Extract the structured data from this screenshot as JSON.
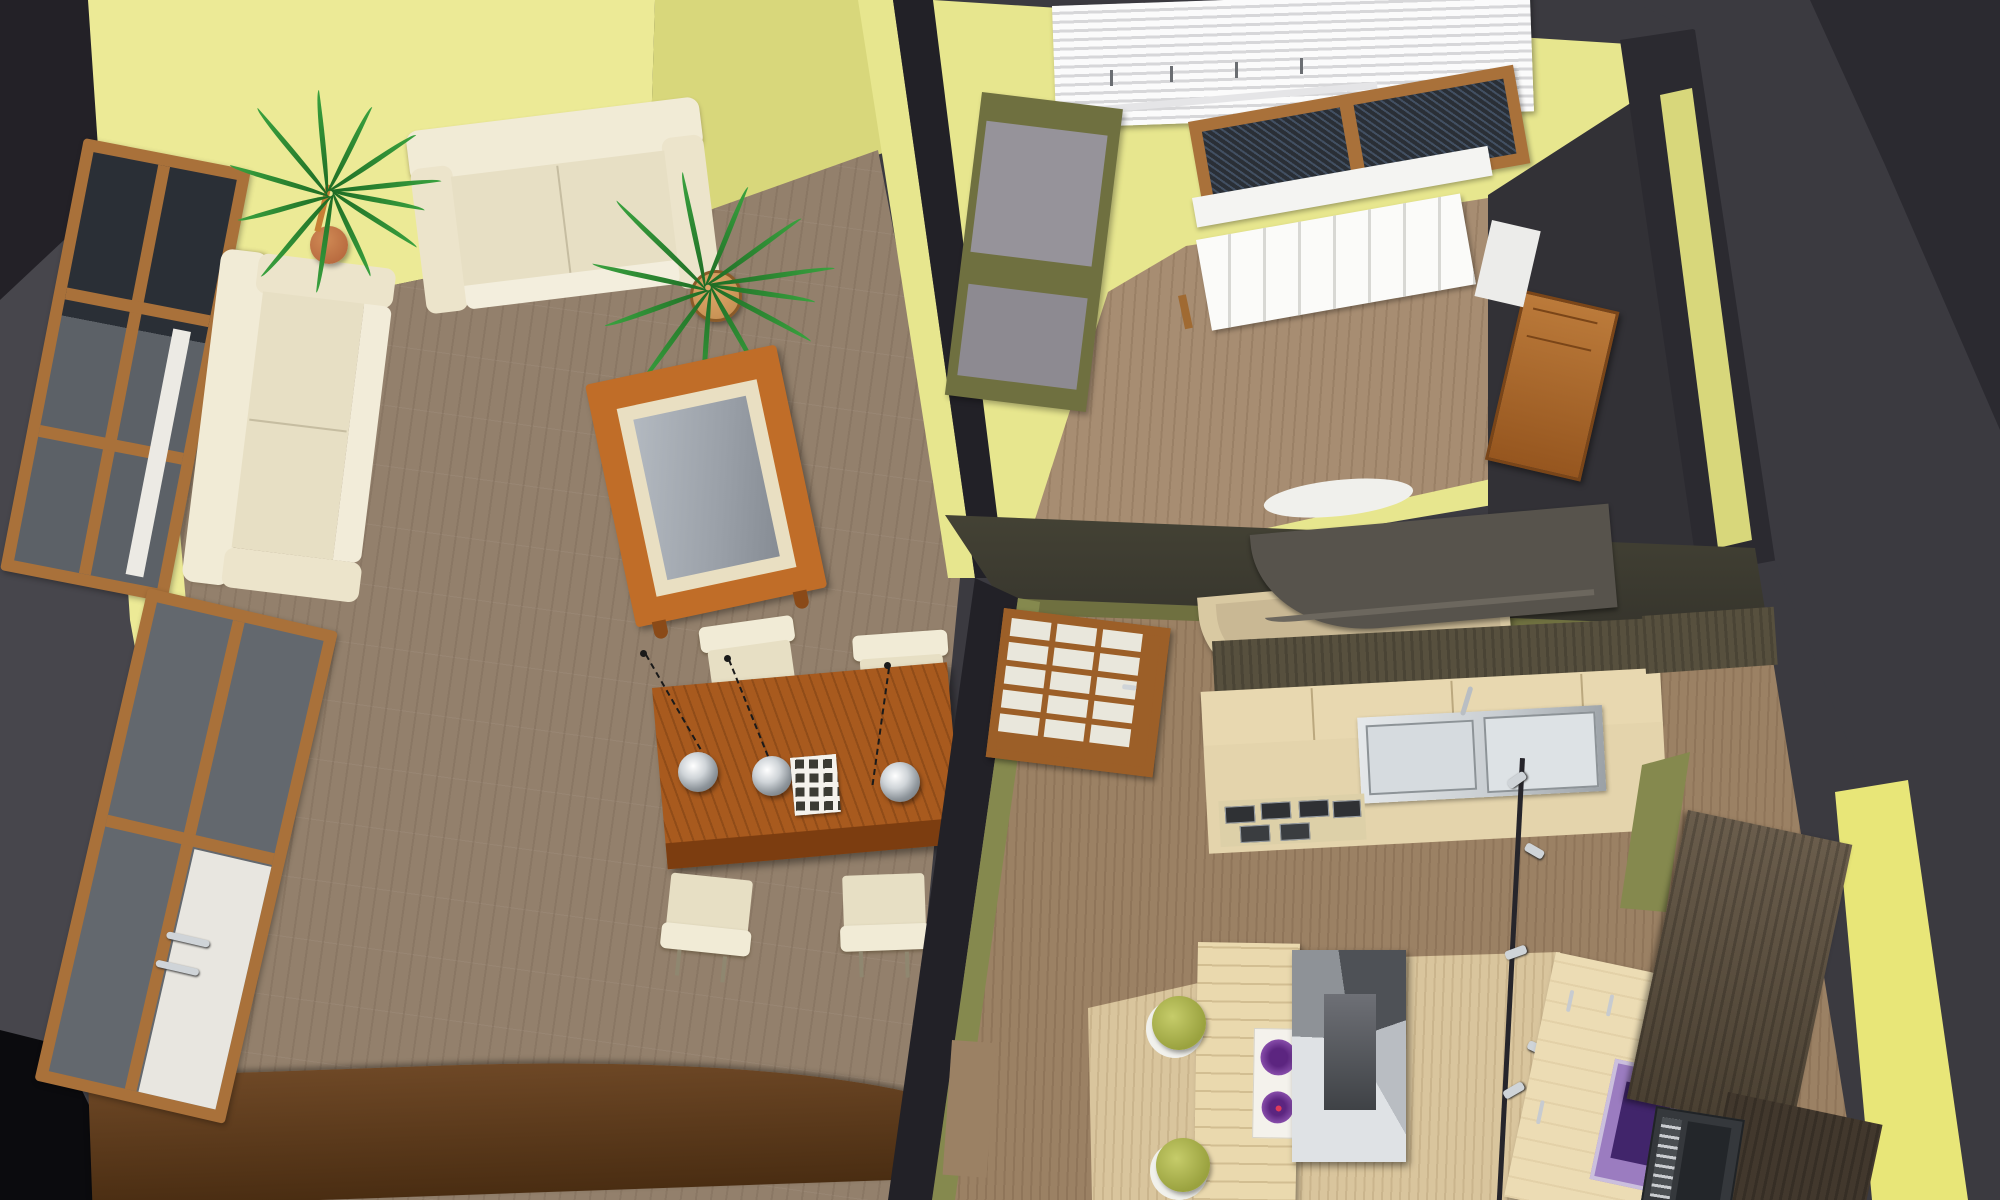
{
  "scene": {
    "type": "3d-interior-rendering",
    "view": "bird's-eye cutaway perspective of a small apartment (no on-screen text)",
    "rooms": [
      {
        "name": "living-room",
        "wall_color": "#ecea96",
        "floor_color": "#93806c",
        "objects": [
          "cream-corner-sofa-long",
          "cream-corner-sofa-short",
          "potted-palm-small",
          "potted-palm-large",
          "coffee-table-with-glass-top",
          "dining-table",
          "dining-chair-x4",
          "pendant-lamp-x3",
          "white-lattice-tray",
          "low-sideboard",
          "wood-frame-window",
          "balcony-door-window"
        ]
      },
      {
        "name": "bedroom",
        "wall_color": "#e7e68e",
        "floor_color": "#a78d72",
        "objects": [
          "venetian-blinds",
          "wood-frame-window-dark-glass",
          "white-windowsill",
          "white-radiator",
          "gray-shelving-unit"
        ]
      },
      {
        "name": "hallway",
        "wall_color": "#323136",
        "objects": [
          "wooden-door",
          "white-door-panel"
        ]
      },
      {
        "name": "kitchen",
        "wall_color": "#85894e",
        "floor_color": "#9b8164",
        "objects": [
          "glazed-interior-door",
          "curved-breakfast-bar",
          "upper-cabinet-run",
          "counter-with-double-sink",
          "faucet",
          "gas-hob",
          "kitchen-island",
          "two-burner-cooktop",
          "extractor-hood",
          "bar-stool-x2",
          "track-light-pole",
          "purple-microwave",
          "purple-oven",
          "walnut-tall-cabinet-x2",
          "dark-built-in-oven"
        ]
      }
    ],
    "counts": {
      "pendant_lamps": 3,
      "dining_chairs": 4,
      "bar_stools": 2,
      "cooktop_burners": 2,
      "glazed_door_rows": 5,
      "glazed_door_cols": 3,
      "living_windows": 2
    },
    "palette": {
      "bg-dark": "#3b3a40",
      "bg-darker": "#2b2a30",
      "corner-dark": "#232127",
      "left-gray": "#47464c",
      "black": "#0b0b0e",
      "wall-yellow": "#ecea96",
      "wall-yellow2": "#d8d77b",
      "wall-yellow3": "#e7e68e",
      "wall-bright": "#e8e678",
      "wall-olive": "#85894e",
      "wall-olive2": "#6f7040",
      "wall-cut": "#222127",
      "wall-band": "#56543f",
      "hall-dark": "#323136",
      "floor-living": "#93806c",
      "floor-bed": "#a78d72",
      "floor-kitchen": "#9b8164",
      "floor-pale": "#d9c59d",
      "wood-frame": "#a9713a",
      "wood-coffee": "#c06d28",
      "wood-dining": "#a85a1e",
      "wood-dining-edge": "#7c3d10",
      "sideboard": "#6e4826",
      "sideboard-dark": "#4a2d12",
      "sofa": "#e7dfc4",
      "sofa-light": "#f1ebd6",
      "sofa-shadow": "#c6bda1",
      "leaf": "#1e6b24",
      "leaf2": "#3aa23f",
      "pot": "#b06038",
      "pot2": "#c08a4e",
      "glass": "#9aa0a8",
      "glass-dark": "#2a2f36",
      "white": "#f4f4f2",
      "steel": "#c9ced2",
      "steel-dark": "#8d9397",
      "chrome": "#cfd4d8",
      "purple": "#9b7cc0",
      "purple-deep": "#41256b",
      "stool": "#9aa23f",
      "walnut": "#57503e",
      "walnut-dark": "#4a4032",
      "beech": "#e8d8b0",
      "beech2": "#d9c9a2",
      "bar-dark": "#57534c",
      "blind": "#fbfbfb",
      "blind-shadow": "#d7d7d9",
      "radiator": "#fbfbf9",
      "pane": "#e9e7dc",
      "cord": "#1a1a1a"
    }
  }
}
